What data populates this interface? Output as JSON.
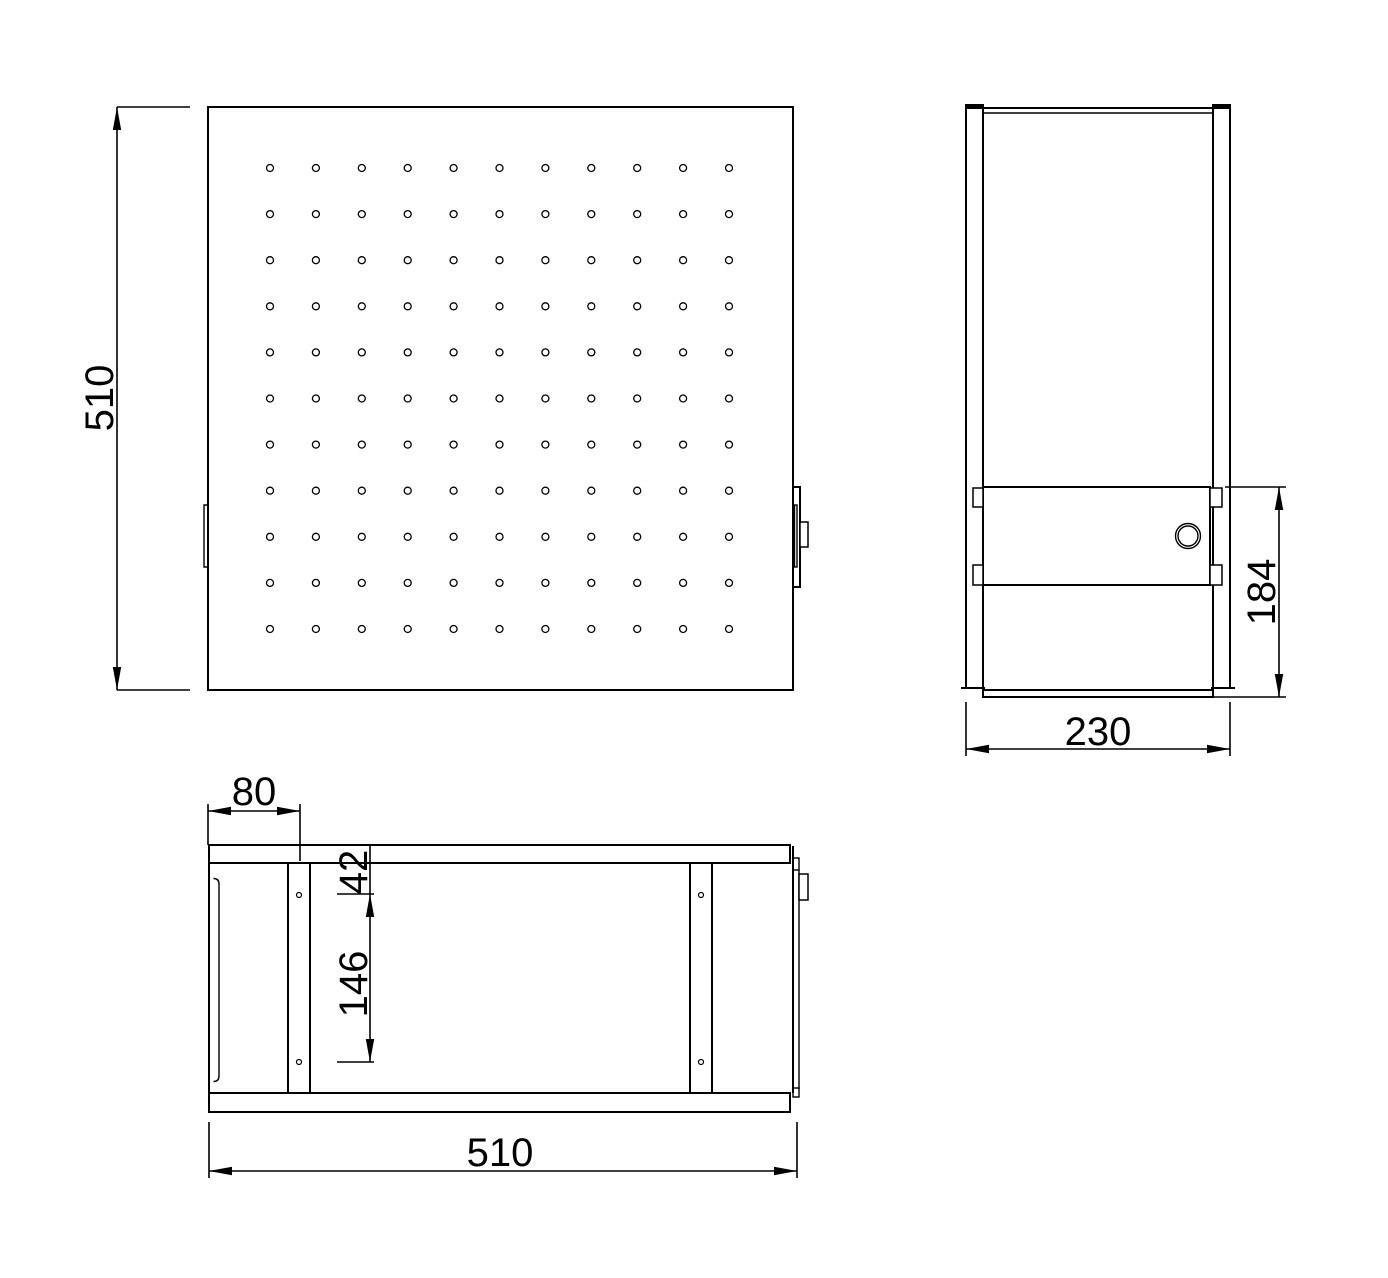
{
  "drawing_type": "three-view-technical-drawing",
  "colors": {
    "line": "#000000",
    "background": "#ffffff"
  },
  "views": {
    "front": {
      "name": "front-view-perforated-panel"
    },
    "side": {
      "name": "side-view"
    },
    "top": {
      "name": "top-view"
    }
  },
  "dims": {
    "front_height": {
      "label": "510"
    },
    "side_width": {
      "label": "230"
    },
    "side_door_height": {
      "label": "184"
    },
    "top_width": {
      "label": "510"
    },
    "top_edge_offset": {
      "label": "80"
    },
    "top_first_hole": {
      "label": "42"
    },
    "top_hole_spacing": {
      "label": "146"
    }
  },
  "front_hole_grid": {
    "cols": 11,
    "rows": 11,
    "x0": 270,
    "y0": 168,
    "dx": 45.9,
    "dy": 46.1,
    "r": 3.5
  },
  "top_view_holes": [
    {
      "cx": 299,
      "cy": 895,
      "r": 2.5
    },
    {
      "cx": 299,
      "cy": 1062,
      "r": 2.5
    },
    {
      "cx": 701,
      "cy": 895,
      "r": 2.5
    },
    {
      "cx": 701,
      "cy": 1062,
      "r": 2.5
    }
  ],
  "side_lock": {
    "cx": 1188,
    "cy": 536,
    "r_outer": 12.5,
    "r_inner": 10
  }
}
